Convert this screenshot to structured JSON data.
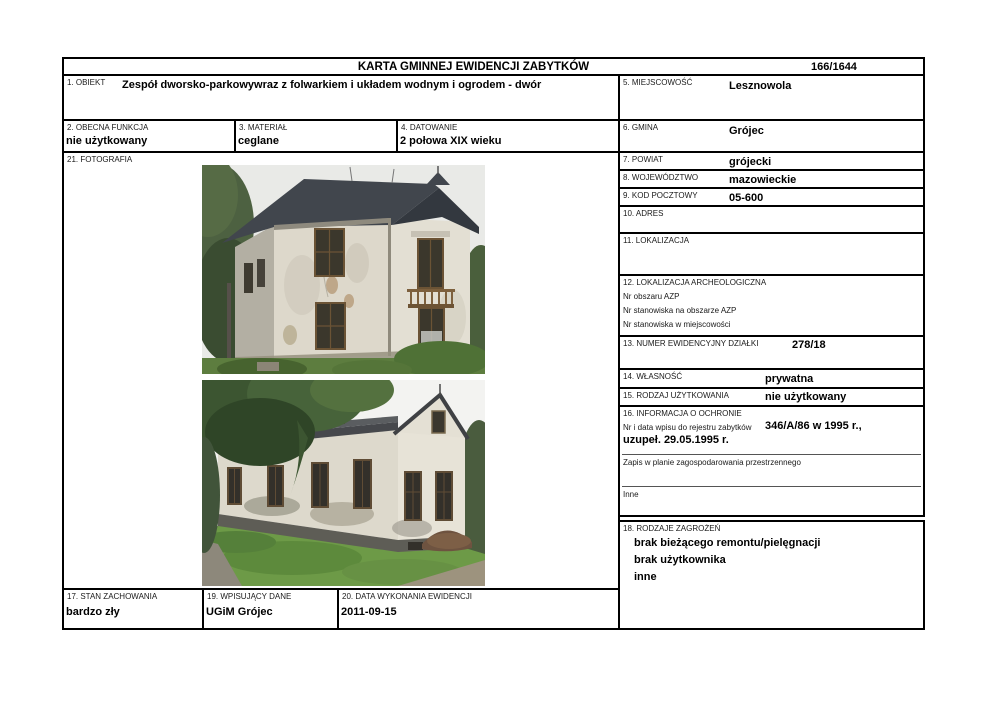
{
  "header": {
    "title": "KARTA GMINNEJ EWIDENCJI ZABYTKÓW",
    "number": "166/1644"
  },
  "fields": {
    "obiekt": {
      "label": "1. OBIEKT",
      "value": "Zespół dworsko-parkowywraz z folwarkiem i układem wodnym i ogrodem - dwór"
    },
    "obecna_funkcja": {
      "label": "2. OBECNA FUNKCJA",
      "value": "nie użytkowany"
    },
    "material": {
      "label": "3. MATERIAŁ",
      "value": "ceglane"
    },
    "datowanie": {
      "label": "4. DATOWANIE",
      "value": "2 połowa XIX wieku"
    },
    "miejscowosc": {
      "label": "5. MIEJSCOWOŚĆ",
      "value": "Lesznowola"
    },
    "gmina": {
      "label": "6. GMINA",
      "value": "Grójec"
    },
    "powiat": {
      "label": "7. POWIAT",
      "value": "grójecki"
    },
    "wojewodztwo": {
      "label": "8. WOJEWÓDZTWO",
      "value": "mazowieckie"
    },
    "kod_pocztowy": {
      "label": "9. KOD POCZTOWY",
      "value": "05-600"
    },
    "adres": {
      "label": "10. ADRES",
      "value": ""
    },
    "lokalizacja": {
      "label": "11. LOKALIZACJA",
      "value": ""
    },
    "lokalizacja_archeologiczna": {
      "label": "12. LOKALIZACJA ARCHEOLOGICZNA",
      "lines": [
        "Nr obszaru AZP",
        "Nr stanowiska na obszarze AZP",
        "Nr stanowiska w miejscowości"
      ]
    },
    "numer_dzialki": {
      "label": "13. NUMER EWIDENCYJNY DZIAŁKI",
      "value": "278/18"
    },
    "wlasnosc": {
      "label": "14. WŁASNOŚĆ",
      "value": "prywatna"
    },
    "rodzaj_uzytkowania": {
      "label": "15. RODZAJ UŻYTKOWANIA",
      "value": "nie użytkowany"
    },
    "informacja_o_ochronie": {
      "label": "16. INFORMACJA O OCHRONIE",
      "rejestr_label": "Nr i data wpisu do rejestru zabytków",
      "rejestr_value": "346/A/86 w 1995 r.,",
      "rejestr_value2": "uzupeł. 29.05.1995 r.",
      "zapis_label": "Zapis w planie zagospodarowania przestrzennego",
      "inne_label": "Inne"
    },
    "stan_zachowania": {
      "label": "17. STAN ZACHOWANIA",
      "value": "bardzo zły"
    },
    "rodzaje_zagrozen": {
      "label": "18. RODZAJE ZAGROŻEŃ",
      "lines": [
        "brak bieżącego remontu/pielęgnacji",
        "brak użytkownika",
        "inne"
      ]
    },
    "wpisujacy_dane": {
      "label": "19. WPISUJĄCY DANE",
      "value": "UGiM Grójec"
    },
    "data_wykonania": {
      "label": "20. DATA WYKONANIA EWIDENCJI",
      "value": "2011-09-15"
    },
    "fotografia": {
      "label": "21. FOTOGRAFIA"
    }
  },
  "colors": {
    "border": "#000000",
    "page_background": "#ffffff",
    "text": "#000000"
  }
}
